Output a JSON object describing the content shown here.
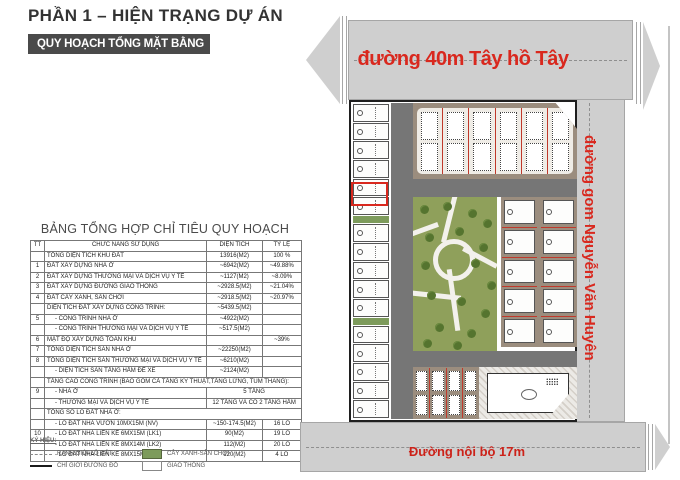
{
  "page": {
    "title": "PHẦN 1 – HIỆN TRẠNG DỰ ÁN",
    "banner": "QUY HOẠCH TỔNG MẶT BẰNG"
  },
  "table": {
    "title": "BẢNG TỔNG HỢP CHỈ TIÊU QUY HOẠCH",
    "columns": [
      "TT",
      "CHỨC NĂNG SỬ DỤNG",
      "DIỆN TÍCH",
      "TỶ LỆ"
    ],
    "rows": [
      {
        "tt": "",
        "label": "TỔNG DIỆN TÍCH KHU ĐẤT",
        "area": "13916(M2)",
        "ratio": "100 %"
      },
      {
        "tt": "1",
        "label": "ĐẤT XÂY DỰNG NHÀ Ở",
        "area": "~6942(M2)",
        "ratio": "~49.88%"
      },
      {
        "tt": "2",
        "label": "ĐẤT XÂY DỰNG THƯƠNG MẠI VÀ DỊCH VỤ Y TẾ",
        "area": "~1127(M2)",
        "ratio": "~8.09%"
      },
      {
        "tt": "3",
        "label": "ĐẤT XÂY DỰNG ĐƯỜNG GIAO THÔNG",
        "area": "~2928.5(M2)",
        "ratio": "~21.04%"
      },
      {
        "tt": "4",
        "label": "ĐẤT CÂY XANH, SÂN CHƠI",
        "area": "~2918.5(M2)",
        "ratio": "~20.97%"
      },
      {
        "tt": "",
        "label": "DIỆN TÍCH ĐẤT XÂY DỰNG CÔNG TRÌNH:",
        "area": "~5439.5(M2)",
        "ratio": ""
      },
      {
        "tt": "5",
        "label": "- CÔNG TRÌNH NHÀ Ở",
        "area": "~4922(M2)",
        "ratio": ""
      },
      {
        "tt": "",
        "label": "- CÔNG TRÌNH THƯƠNG MẠI  VÀ DỊCH VỤ Y TẾ",
        "area": "~517.5(M2)",
        "ratio": ""
      },
      {
        "tt": "6",
        "label": "MẬT ĐỘ XÂY DỰNG TOÀN KHU",
        "area": "",
        "ratio": "~39%"
      },
      {
        "tt": "7",
        "label": "TỔNG DIỆN TÍCH SÀN NHÀ Ở",
        "area": "~22250(M2)",
        "ratio": ""
      },
      {
        "tt": "8",
        "label": "TỔNG DIỆN TÍCH SÀN THƯƠNG MẠI VÀ DỊCH VỤ Y TẾ",
        "area": "~6210(M2)",
        "ratio": ""
      },
      {
        "tt": "",
        "label": "- DIỆN TÍCH SÀN TẦNG HẦM ĐỂ XE",
        "area": "~2124(M2)",
        "ratio": ""
      },
      {
        "tt": "",
        "label": "TẦNG CAO CÔNG TRÌNH (BAO GỒM CẢ TẦNG KỸ THUẬT,TẦNG LỬNG, TUM THANG):",
        "span_all": true
      },
      {
        "tt": "9",
        "label": "- NHÀ Ở",
        "value": "5 TẦNG",
        "span_value": true
      },
      {
        "tt": "",
        "label": "- THƯƠNG MẠI VÀ DỊCH VỤ Y TẾ",
        "value": "12 TẦNG VÀ CÓ 2 TẦNG HẦM",
        "span_value": true
      },
      {
        "tt": "",
        "label": "TỔNG SỐ LÔ ĐẤT NHÀ Ở:",
        "span_all": true
      },
      {
        "tt": "",
        "label": "- LÔ ĐẤT NHÀ VƯỜN 10MX15M (NV)",
        "area": "~150-174.5(M2)",
        "ratio": "16 LÔ"
      },
      {
        "tt": "10",
        "label": "- LÔ ĐẤT NHÀ LIỀN KỀ 6MX15M (LK1)",
        "area": "90(M2)",
        "ratio": "19 LÔ"
      },
      {
        "tt": "",
        "label": "- LÔ ĐẤT NHÀ LIỀN KỀ 8MX14M (LK2)",
        "area": "112(M2)",
        "ratio": "20 LÔ"
      },
      {
        "tt": "",
        "label": "- LÔ ĐẤT NHÀ LIỀN KỀ 8MX15M (LK3)",
        "area": "120(M2)",
        "ratio": "4 LÔ"
      }
    ]
  },
  "legend": {
    "title": "KÝ HIỆU:",
    "items": [
      {
        "symbol": "dashed-line",
        "label": "RANH GIỚI LÔ ĐẤT"
      },
      {
        "symbol": "green-box",
        "label": "CÂY XANH-SÂN CHƠI"
      },
      {
        "symbol": "solid-line",
        "label": "CHỈ GIỚI ĐƯỜNG ĐỎ"
      },
      {
        "symbol": "white-box",
        "label": "GIAO THÔNG"
      }
    ]
  },
  "map": {
    "roads": {
      "top": "đường 40m Tây hồ Tây",
      "right": "đường gom Nguyễn Văn Huyên",
      "bottom": "Đường nội bộ 17m"
    },
    "blocks": {
      "left_strip_groups": [
        6,
        5,
        5
      ],
      "top_block_cols": 6,
      "right_block_cols": 2,
      "right_block_rows": 5,
      "bottom_block_cols": 4
    },
    "colors": {
      "accent_red": "#d9281e",
      "road_gray": "#cfcfcf",
      "inner_road_gray": "#767676",
      "park_green": "#8fa05b",
      "block_tan": "#9b8d7e",
      "legend_green": "#7d9b5b",
      "banner_gray": "#4a4a4a"
    }
  }
}
